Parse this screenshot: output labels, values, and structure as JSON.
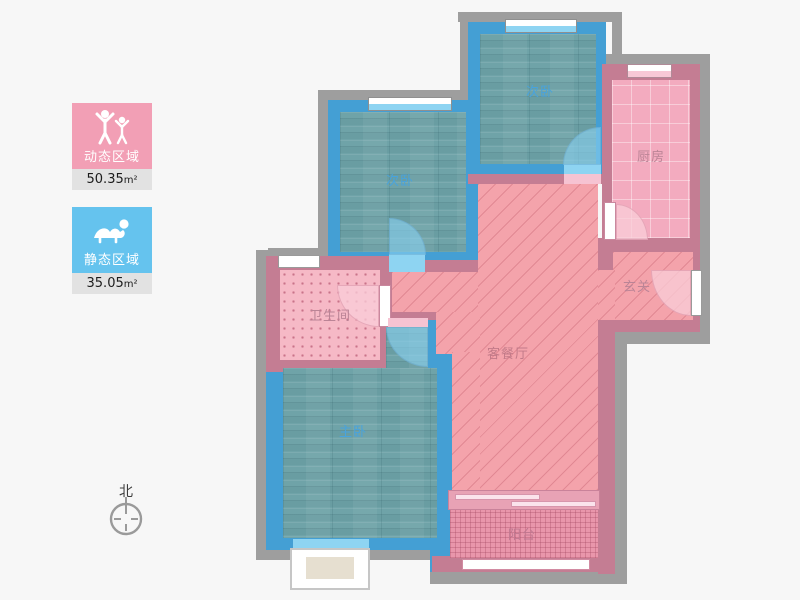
{
  "legend": {
    "dynamic": {
      "label": "动态区域",
      "area": "50.35",
      "unit": "m²",
      "color": "#f29fb5"
    },
    "static": {
      "label": "静态区域",
      "area": "35.05",
      "unit": "m²",
      "color": "#65c3ee"
    }
  },
  "compass": {
    "north_label": "北"
  },
  "rooms": {
    "bedroom_top": {
      "label": "次卧"
    },
    "bedroom_mid": {
      "label": "次卧"
    },
    "kitchen": {
      "label": "厨房"
    },
    "entry": {
      "label": "玄关"
    },
    "bathroom": {
      "label": "卫生间"
    },
    "living": {
      "label": "客餐厅"
    },
    "master": {
      "label": "主卧"
    },
    "balcony": {
      "label": "阳台"
    }
  },
  "colors": {
    "wall_blue": "#449fd4",
    "wall_pink": "#c47d93",
    "wall_gray": "#9e9e9e",
    "floor_wood_teal": "#6fa3a8",
    "floor_living_pink": "#f4a3ab",
    "floor_kitchen_pink": "#f3abbf",
    "floor_bath_pink": "#f6b9c6",
    "floor_balcony_pink": "#e996ab",
    "window_glass_blue": "#8ed4f2",
    "window_glass_pink": "#f8c8d6",
    "label_blue": "#48a3dd",
    "label_pink": "#bb8496",
    "page_bg": "#f7f7f7"
  }
}
